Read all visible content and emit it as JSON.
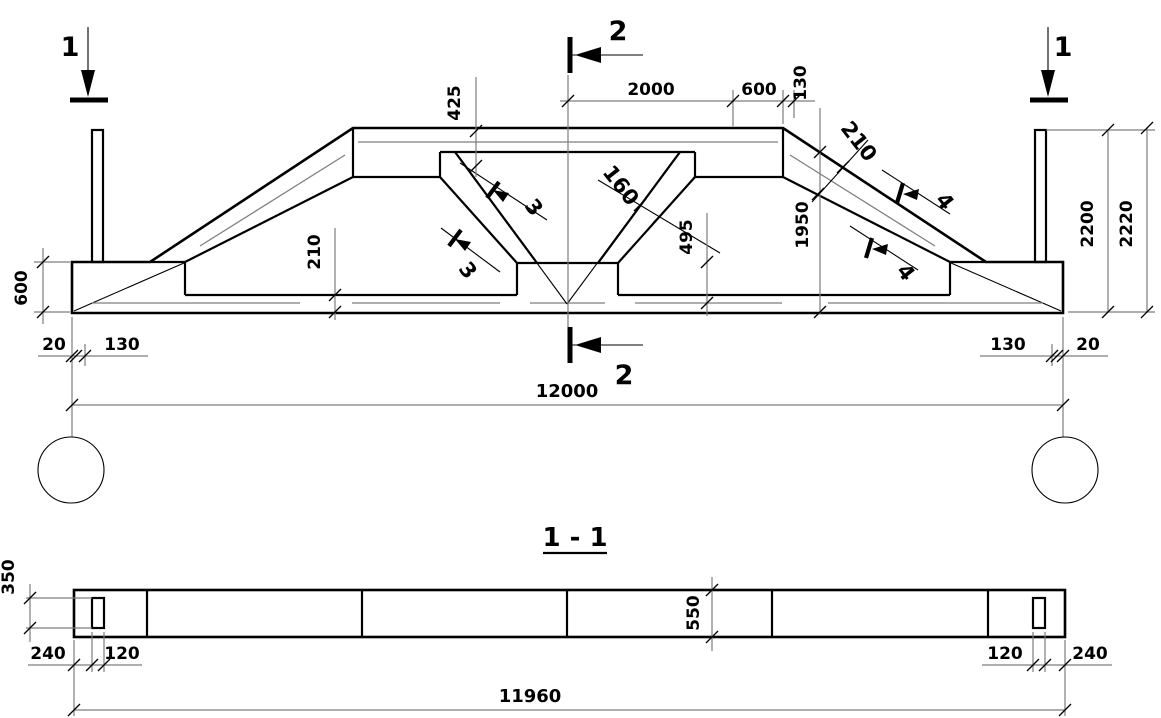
{
  "elevation": {
    "marker1": "1",
    "marker2": "2",
    "marker3": "3",
    "marker4": "4",
    "dim2000": "2000",
    "dim600top": "600",
    "dim130top": "130",
    "dim425": "425",
    "dim160": "160",
    "dim495": "495",
    "dim1950": "1950",
    "dim210chord": "210",
    "dim210bottom": "210",
    "dim2200": "2200",
    "dim2220": "2220",
    "dim600left": "600",
    "dim20left": "20",
    "dim130left": "130",
    "dim130right": "130",
    "dim20right": "20",
    "dim12000": "12000"
  },
  "plan": {
    "title": "1 - 1",
    "dim350": "350",
    "dim550": "550",
    "dim240left": "240",
    "dim120left": "120",
    "dim120right": "120",
    "dim240right": "240",
    "dim11960": "11960"
  },
  "colors": {
    "line": "#000000",
    "thin_line": "#7d7d7d",
    "background": "#ffffff"
  }
}
